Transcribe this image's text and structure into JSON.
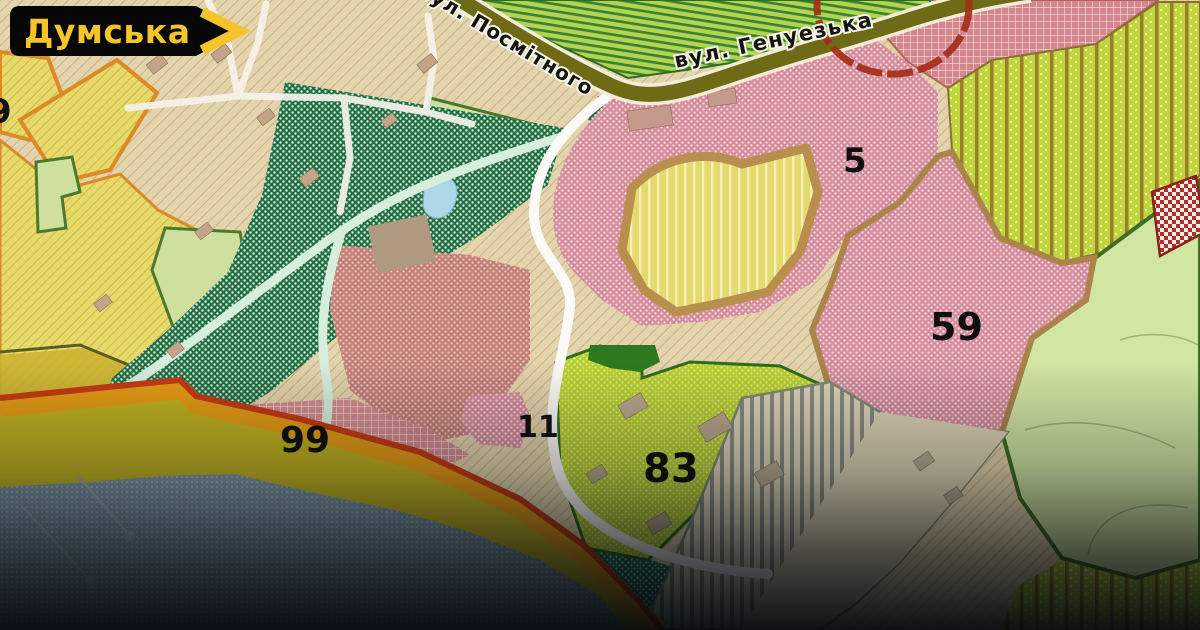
{
  "badge": {
    "label": "Думська",
    "bg_color": "#070707",
    "accent_color": "#f4c42a"
  },
  "map": {
    "street_labels": [
      {
        "name": "вул. Посмітного"
      },
      {
        "name": "вул. Генуезька"
      }
    ],
    "zone_numbers": [
      {
        "value": "9"
      },
      {
        "value": "5"
      },
      {
        "value": "59"
      },
      {
        "value": "83"
      },
      {
        "value": "11"
      },
      {
        "value": "99"
      }
    ],
    "legend_colors": {
      "base_tan": "#e4d4ac",
      "farmland_yellow": "#e8d967",
      "park_green": "#1f7047",
      "residential_pink": "#d8899a",
      "recreation_yellow_green": "#b8ce33",
      "beach_olive": "#c2b31d",
      "coast_orange": "#e89c10",
      "coast_red": "#c83a10",
      "water_blue": "#7e96a5",
      "road_olive": "#6e6a14"
    },
    "annotations": {
      "highlight_circle_color": "#a62c18"
    }
  }
}
